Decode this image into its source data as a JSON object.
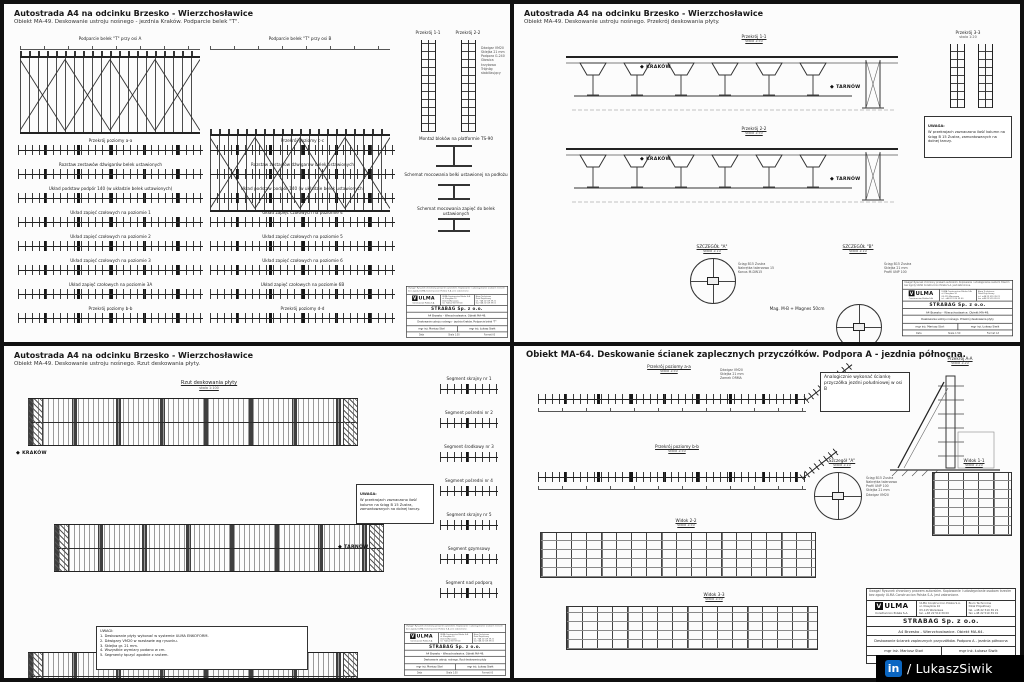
{
  "watermark": {
    "icon": "in",
    "text": "/ LukaszSiwik",
    "blue": "#0a66c2"
  },
  "tl": {
    "title": "Autostrada A4 na odcinku Brzesko - Wierzchosławice",
    "subtitle": "Obiekt MA-49. Deskowanie ustroju nośnego - jezdnia Kraków. Podparcie belek \"T\".",
    "truss_a_label": "Podparcie belek \"T\" przy osi A",
    "truss_b_label": "Podparcie belek \"T\" przy osi B",
    "sec1": "Przekrój 1-1",
    "sec2": "Przekrój 2-2",
    "det1": "Montaż bloków na platformie TS-90",
    "det2": "Schemat mocowania belki ustawionej na podłożu",
    "det3": "Schemat mocowania zapięć do belek ustawionych",
    "ann_tower": "Dźwigar VM20\nSklejka 21 mm\nPodpora G-240\nGłowica krzyżowa\nTrójnóg stabilizujący",
    "strips_left": [
      "Przekrój poziomy a-a",
      "Rozstaw zestawów dźwigarów belek ustawionych",
      "Układ podstaw podpór 140 (w układzie belek ustawionych)",
      "Układ zapięć czołowych na poziomie 1",
      "Układ zapięć czołowych na poziomie 2",
      "Układ zapięć czołowych na poziomie 3",
      "Układ zapięć czołowych na poziomie 3A",
      "Przekrój poziomy b-b"
    ],
    "strips_right": [
      "Przekrój poziomy c-c",
      "Rozstaw zestawów dźwigarów belek ustawionych",
      "Układ podstaw podpór 140 (w układzie belek ustawionych)",
      "Układ zapięć czołowych na poziomie 4",
      "Układ zapięć czołowych na poziomie 5",
      "Układ zapięć czołowych na poziomie 6",
      "Układ zapięć czołowych na poziomie 6B",
      "Przekrój poziomy d-d"
    ]
  },
  "tr": {
    "title": "Autostrada A4 na odcinku Brzesko - Wierzchosławice",
    "subtitle": "Obiekt MA-49. Deskowanie ustroju nośnego. Przekrój deskowania płyty.",
    "sec1": "Przekrój 1-1",
    "sec1_scale": "skala 1:50",
    "sec2": "Przekrój 2-2",
    "sec2_scale": "skala 1:50",
    "sec3": "Przekrój 3-3",
    "sec3_scale": "skala 1:20",
    "krakow": "KRAKÓW",
    "tarnow": "TARNÓW",
    "note": "W przekrojach zaznaczono ilość kolumn na ściąg B 15 Zustra, zamontowanych na dolnej tarczy.",
    "note_title": "UWAGA:",
    "detA": "SZCZEGÓŁ \"A\"",
    "detA_scale": "skala 1:10",
    "detB": "SZCZEGÓŁ \"B\"",
    "detB_scale": "skala 1:10",
    "caption": "Mag. M-B + Magnes 50cm",
    "annA": "Ściąg B15 Zustra\nNakrętka talerzowa 15\nKonus M-DW15",
    "annB": "Ściąg B15 Zustra\nSklejka 21 mm\nProfil UNP 100"
  },
  "bl": {
    "title": "Autostrada A4 na odcinku Brzesko - Wierzchosławice",
    "subtitle": "Obiekt MA-49. Deskowanie ustroju nośnego. Rzut deskowania płyty.",
    "plan_label": "Rzut deskowania płyty",
    "plan_scale": "skala 1:100",
    "krakow": "KRAKÓW",
    "tarnow": "TARNÓW",
    "note_title": "UWAGA:",
    "note": "W przekrojach zaznaczono ilość kolumn na ściąg B 15 Zustra, zamontowanych na dolnej tarczy.",
    "legend": "UWAGI:\n1. Deskowanie płyty wykonać w systemie ULMA ENKOFORM.\n2. Dźwigary VM20 w rozstawie wg rysunku.\n3. Sklejka gr. 21 mm.\n4. Wszystkie wymiary podano w cm.\n5. Segmenty łączyć zgodnie z rzutem.",
    "segments": [
      "Segment skrajny nr 1",
      "Segment pośredni nr 2",
      "Segment środkowy nr 3",
      "Segment pośredni nr 4",
      "Segment skrajny nr 5",
      "Segment gzymsowy",
      "Segment nad podporą"
    ]
  },
  "br": {
    "title": "Obiekt MA-64. Deskowanie ścianek zaplecznych przyczółków. Podpora A - jezdnia północna.",
    "sec_a": "Przekrój poziomy a-a",
    "sec_a_scale": "skala 1:50",
    "sec_b": "Przekrój poziomy b-b",
    "sec_b_scale": "skala 1:50",
    "view2": "Widok 2-2",
    "view2_scale": "skala 1:50",
    "view3": "Widok 3-3",
    "view3_scale": "skala 1:50",
    "secAA": "Przekrój A-A",
    "secAA_scale": "skala 1:20",
    "view1": "Widok 1-1",
    "view1_scale": "skala 1:20",
    "detA": "Szczegół \"A\"",
    "detA_scale": "skala 1:10",
    "note": "Analogicznie wykonać ściankę przyczółka jezdni południowej w osi B",
    "ann_strip": "Dźwigar VM20\nSklejka 21 mm\nZamek ORMA",
    "ann_det": "Ściąg B15 Zustra\nNakrętka talerzowa\nProfil UNP 100\nSklejka 21 mm\nDźwigar VM20"
  },
  "titleblock": {
    "disclaimer": "Uwaga! Rysunek chroniony prawem autorskim. Kopiowanie i udostępnianie osobom trzecim bez zgody ULMA Construccion Polska S.A. jest zabronione.",
    "logo_name": "ULMA",
    "logo_mark": "V",
    "logo_sub": "Construccion Polska S.A.",
    "addr_left": "ULMA Construccion Polska S.A.\nul. Klasyków 10\n03-115 Warszawa\ntel. +48 22 519 39 00",
    "addr_right": "Biuro Techniczne\nDział Projektowy\ntel. +48 22 519 39 21\nfax +48 22 519 39 01",
    "client": "STRABAG  Sp. z o.o.",
    "project_ma49": "A4 Brzesko - Wierzchosławice. Obiekt MA-49.",
    "project_ma64": "A4 Brzesko - Wierzchosławice. Obiekt MA-64.",
    "drawing_tl": "Deskowanie ustroju nośnego - jezdnia Kraków. Podparcie belek \"T\"",
    "drawing_tr": "Deskowanie ustroju nośnego. Przekrój deskowania płyty",
    "drawing_bl": "Deskowanie ustroju nośnego. Rzut deskowania płyty",
    "drawing_br": "Deskowanie ścianek zaplecznych przyczółków. Podpora A - jezdnia północna",
    "author_left": "mgr inż. Mariusz Stoń",
    "author_right": "mgr inż. Łukasz Siwik",
    "foot1": "Data",
    "foot2": "Skala 1:50",
    "foot3": "Format A3"
  }
}
